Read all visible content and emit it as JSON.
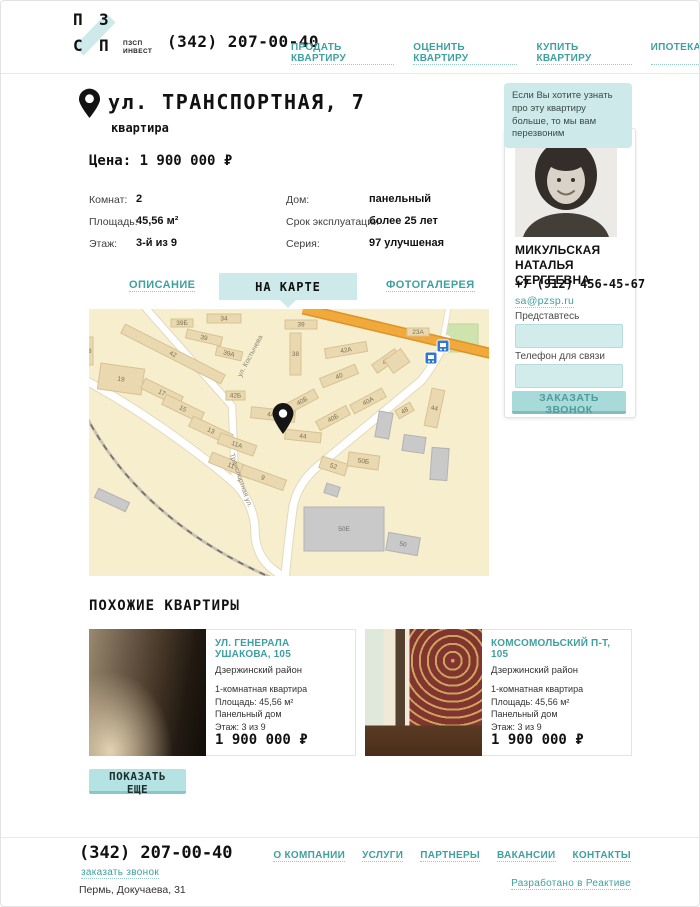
{
  "colors": {
    "teal": "#3fa0a0",
    "teal_light": "#cde9ea",
    "button": "#a9dada",
    "map_bg": "#f7eecd",
    "map_building": "#ead9b0",
    "map_building_gray": "#c9c9c9",
    "road_orange": "#f2a93b"
  },
  "header": {
    "logo": {
      "l1": "П",
      "l2": "З",
      "l3": "С",
      "l4": "П",
      "sub1": "ПЗСП",
      "sub2": "ИНВЕСТ"
    },
    "phone": "(342) 207-00-40",
    "nav": [
      {
        "label": "ПРОДАТЬ КВАРТИРУ"
      },
      {
        "label": "ОЦЕНИТЬ КВАРТИРУ"
      },
      {
        "label": "КУПИТЬ КВАРТИРУ"
      },
      {
        "label": "ИПОТЕКА"
      }
    ]
  },
  "listing": {
    "title": "ул. ТРАНСПОРТНАЯ, 7",
    "subtitle": "квартира",
    "price_line": "Цена: 1 900 000  ₽",
    "specs_left": [
      {
        "label": "Комнат:",
        "value": "2"
      },
      {
        "label": "Площадь:",
        "value": "45,56 м²"
      },
      {
        "label": "Этаж:",
        "value": "3-й из 9"
      }
    ],
    "specs_right": [
      {
        "label": "Дом:",
        "value": "панельный"
      },
      {
        "label": "Срок эксплуатации",
        "value": "более 25 лет"
      },
      {
        "label": "Серия:",
        "value": "97 улучшеная"
      }
    ]
  },
  "tabs": [
    {
      "label": "ОПИСАНИЕ",
      "active": false
    },
    {
      "label": "НА КАРТЕ",
      "active": true
    },
    {
      "label": "ФОТОГАЛЕРЕЯ",
      "active": false
    }
  ],
  "map": {
    "streets": [
      {
        "t": "ул. Костычева",
        "x": 163,
        "y": 48,
        "rot": -62
      },
      {
        "t": "Транспортная ул.",
        "x": 150,
        "y": 172,
        "rot": 71
      }
    ],
    "buildings": [
      [
        82,
        10,
        22,
        8,
        0,
        "39Б",
        "t"
      ],
      [
        118,
        5,
        34,
        9,
        0,
        "34",
        "t"
      ],
      [
        97,
        24,
        36,
        9,
        13,
        "39",
        "t"
      ],
      [
        127,
        40,
        26,
        9,
        13,
        "39А",
        "t"
      ],
      [
        28,
        40,
        112,
        10,
        27,
        "42",
        "t"
      ],
      [
        10,
        57,
        44,
        26,
        8,
        "19",
        "t"
      ],
      [
        52,
        78,
        42,
        11,
        26,
        "17",
        "t"
      ],
      [
        73,
        94,
        42,
        11,
        26,
        "15",
        "t"
      ],
      [
        137,
        82,
        19,
        9,
        0,
        "42Б",
        "t"
      ],
      [
        100,
        116,
        44,
        11,
        25,
        "13",
        "t"
      ],
      [
        129,
        130,
        38,
        11,
        20,
        "11А",
        "t"
      ],
      [
        120,
        151,
        44,
        11,
        22,
        "11",
        "t"
      ],
      [
        151,
        163,
        46,
        11,
        20,
        "9",
        "t"
      ],
      [
        196,
        11,
        32,
        9,
        0,
        "39",
        "t"
      ],
      [
        201,
        24,
        11,
        42,
        0,
        "38",
        "t"
      ],
      [
        236,
        36,
        42,
        10,
        -10,
        "42А",
        "t"
      ],
      [
        231,
        62,
        38,
        10,
        -22,
        "40",
        "t"
      ],
      [
        197,
        87,
        32,
        10,
        -28,
        "40Б",
        "t"
      ],
      [
        162,
        100,
        44,
        11,
        6,
        "44А",
        "t"
      ],
      [
        227,
        104,
        34,
        10,
        -28,
        "40Б",
        "t"
      ],
      [
        261,
        87,
        36,
        10,
        -28,
        "40А",
        "t"
      ],
      [
        196,
        122,
        36,
        10,
        6,
        "44",
        "t"
      ],
      [
        283,
        47,
        28,
        10,
        -35,
        "42",
        "t"
      ],
      [
        318,
        19,
        22,
        8,
        0,
        "23А",
        "t"
      ],
      [
        339,
        80,
        13,
        38,
        12,
        "44",
        "t"
      ],
      [
        307,
        97,
        17,
        9,
        -30,
        "48",
        "t"
      ],
      [
        231,
        151,
        27,
        12,
        18,
        "52",
        "t"
      ],
      [
        259,
        145,
        31,
        14,
        8,
        "50Б",
        "t"
      ],
      [
        298,
        44,
        20,
        16,
        -35,
        "",
        "t"
      ],
      [
        -6,
        28,
        10,
        28,
        0,
        "38",
        "t"
      ],
      [
        288,
        103,
        14,
        26,
        10,
        "",
        "g"
      ],
      [
        314,
        127,
        22,
        16,
        8,
        "",
        "g"
      ],
      [
        342,
        139,
        17,
        32,
        4,
        "",
        "g"
      ],
      [
        298,
        226,
        32,
        18,
        10,
        "50",
        "g"
      ],
      [
        215,
        198,
        80,
        44,
        0,
        "50Е",
        "g"
      ],
      [
        6,
        186,
        34,
        10,
        25,
        "",
        "g"
      ],
      [
        236,
        176,
        14,
        10,
        18,
        "",
        "g"
      ]
    ]
  },
  "agent": {
    "bubble": "Если Вы хотите узнать про эту квартиру больше, то мы вам перезвоним",
    "name": "МИКУЛЬСКАЯ НАТАЛЬЯ СЕРГЕЕВНА",
    "phone": "+7 (912) 456-45-67",
    "email": "sa@pzsp.ru",
    "form": {
      "name_label": "Представтесь",
      "phone_label": "Телефон для связи",
      "submit": "ЗАКАЗАТЬ ЗВОНОК"
    }
  },
  "similar": {
    "heading": "ПОХОЖИЕ КВАРТИРЫ",
    "more": "ПОКАЗАТЬ ЕЩЕ",
    "cards": [
      {
        "title": "УЛ. ГЕНЕРАЛА УШАКОВА, 105",
        "district": "Дзержинский район",
        "lines": [
          "1-комнатная квартира",
          "Площадь: 45,56 м²",
          "Панельный дом",
          "Этаж: 3 из 9"
        ],
        "price": "1 900 000 ₽"
      },
      {
        "title": "КОМСОМОЛЬСКИЙ П-Т, 105",
        "district": "Дзержинский район",
        "lines": [
          "1-комнатная квартира",
          "Площадь: 45,56 м²",
          "Панельный дом",
          "Этаж: 3 из 9"
        ],
        "price": "1 900 000 ₽"
      }
    ]
  },
  "footer": {
    "phone": "(342) 207-00-40",
    "callback": "заказать звонок",
    "address": "Пермь, Докучаева, 31",
    "nav": [
      {
        "label": "О КОМПАНИИ"
      },
      {
        "label": "УСЛУГИ"
      },
      {
        "label": "ПАРТНЕРЫ"
      },
      {
        "label": "ВАКАНСИИ"
      },
      {
        "label": "КОНТАКТЫ"
      }
    ],
    "credit": "Разработано в Реактиве"
  }
}
